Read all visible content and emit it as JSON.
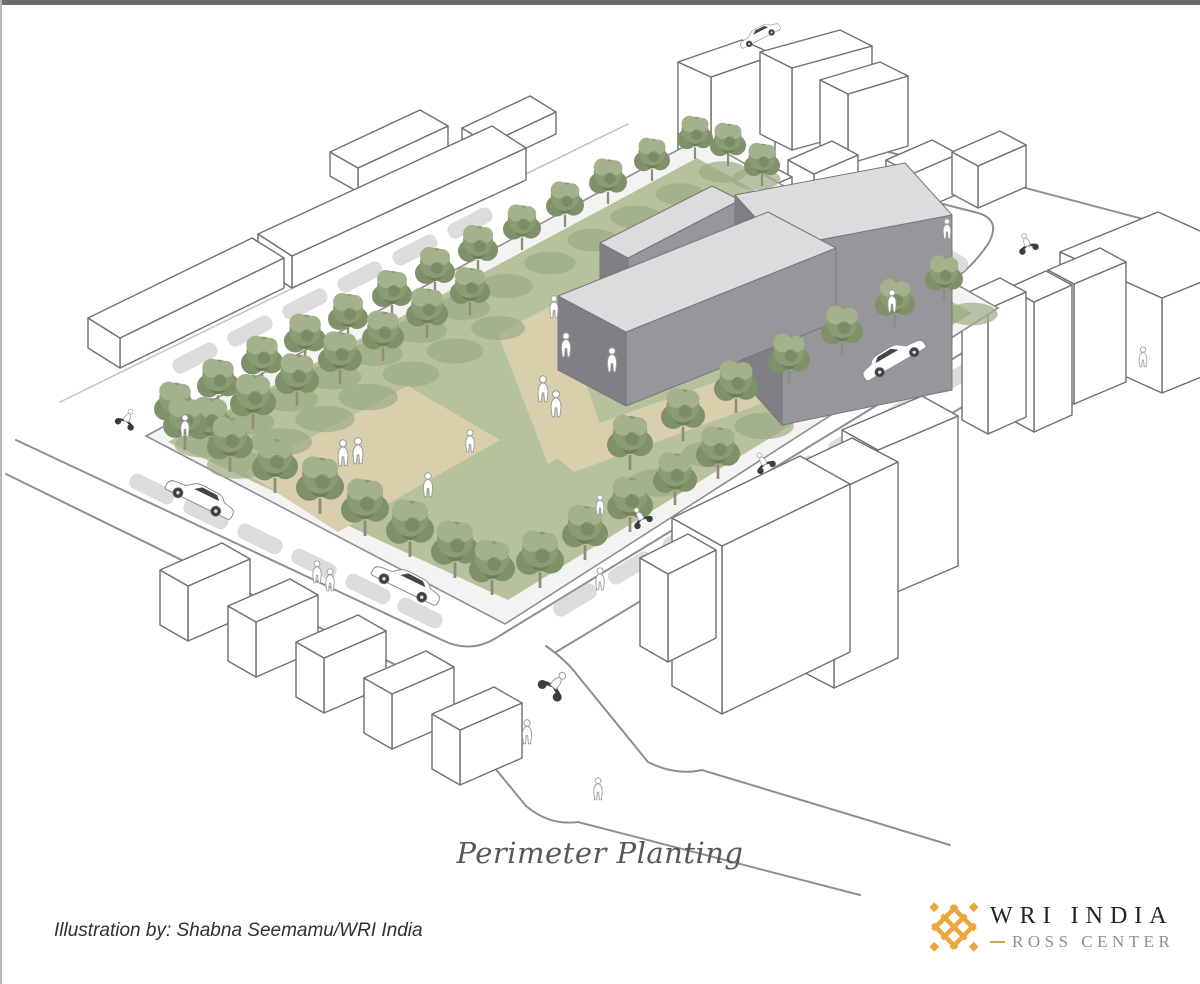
{
  "caption": {
    "title": "Perimeter Planting"
  },
  "attribution": {
    "text": "Illustration by: Shabna Seemamu/WRI India"
  },
  "logo": {
    "org": "WRI INDIA",
    "sub": "ROSS CENTER"
  },
  "colors": {
    "background": "#ffffff",
    "top_bar": "#6a6a6a",
    "border_left": "#b7b7b7",
    "title_color": "#585858",
    "attr_color": "#303030",
    "logo_navy": "#21242e",
    "logo_gray": "#8e8e8e",
    "logo_gold": "#cfa156",
    "brand_gold": "#eaa73c",
    "grass": "#b5c29c",
    "grass_shadow": "#9cab84",
    "path_tan": "#d9cfad",
    "sidewalk": "#f3f3f1",
    "curb": "#8f8f8f",
    "street": "#8f8f8f",
    "street_faint": "#c2c2c2",
    "car_shadow": "#d6d6d6",
    "bldg_fill": "#ffffff",
    "outline": "#707070",
    "roof": "#dcdcde",
    "wall_mid": "#97979b",
    "wall_dark": "#7f7f84",
    "tree_g1": "#8a9c74",
    "tree_g2": "#7f9168",
    "tree_g3": "#a3b28c",
    "tree_g4": "#6e8059",
    "trunk": "#8f8c7c"
  },
  "illustration": {
    "site": {
      "sidewalk": "146,436 700,138 998,308 505,624",
      "grass": "168,442 697,158 972,313 508,600",
      "paths": [
        "245,472 408,386 500,440 338,532",
        "498,334 558,302 602,430 548,464",
        "540,444 760,366 794,392 574,472"
      ]
    },
    "gray_buildings": [
      {
        "roof": "600,243 712,186 740,200 628,258",
        "front": "628,258 740,200 740,242 628,300",
        "end": "600,243 628,258 628,300 600,285"
      },
      {
        "roof": "735,195 905,163 952,215 782,247",
        "front": "782,247 952,215 952,390 782,425",
        "end": "735,195 782,247 782,425 735,372"
      },
      {
        "roof": "558,296 768,212 836,248 626,332",
        "front": "626,332 836,248 836,322 626,406",
        "end": "558,296 626,332 626,406 558,370"
      }
    ],
    "streets": [
      "M 16,440 L 442,640 Q 470,654 496,638 L 1000,330",
      "M 6,474 L 398,666 Q 420,676 434,694 L 526,806",
      "M 546,646 Q 566,660 578,676 L 648,762",
      "M 648,762 Q 676,776 702,770 L 950,845",
      "M 526,806 Q 550,826 578,822 L 860,895",
      "M 556,652 L 1090,330",
      "M 866,146 L 1200,234",
      "M 850,180 L 978,213 Q 1002,220 988,244 Q 972,268 948,284 L 902,318"
    ],
    "streets_faint": [
      "M 60,402 L 628,124"
    ],
    "context_prisms": [
      {
        "q": [
          [
            330,
            152
          ],
          [
            420,
            110
          ],
          [
            448,
            126
          ],
          [
            358,
            168
          ]
        ],
        "h": 24
      },
      {
        "q": [
          [
            462,
            128
          ],
          [
            530,
            96
          ],
          [
            556,
            112
          ],
          [
            488,
            144
          ]
        ],
        "h": 22
      },
      {
        "q": [
          [
            258,
            234
          ],
          [
            492,
            126
          ],
          [
            526,
            148
          ],
          [
            292,
            256
          ]
        ],
        "h": 32
      },
      {
        "q": [
          [
            88,
            318
          ],
          [
            252,
            238
          ],
          [
            284,
            258
          ],
          [
            120,
            338
          ]
        ],
        "h": 30
      },
      {
        "q": [
          [
            678,
            62
          ],
          [
            742,
            40
          ],
          [
            775,
            55
          ],
          [
            711,
            77
          ]
        ],
        "h": 108
      },
      {
        "q": [
          [
            760,
            52
          ],
          [
            840,
            30
          ],
          [
            872,
            46
          ],
          [
            792,
            68
          ]
        ],
        "h": 82
      },
      {
        "q": [
          [
            820,
            80
          ],
          [
            880,
            62
          ],
          [
            908,
            76
          ],
          [
            848,
            94
          ]
        ],
        "h": 70
      },
      {
        "q": [
          [
            788,
            160
          ],
          [
            832,
            141
          ],
          [
            858,
            155
          ],
          [
            814,
            174
          ]
        ],
        "h": 36
      },
      {
        "q": [
          [
            722,
            182
          ],
          [
            766,
            163
          ],
          [
            792,
            177
          ],
          [
            748,
            196
          ]
        ],
        "h": 36
      },
      {
        "q": [
          [
            886,
            160
          ],
          [
            932,
            140
          ],
          [
            958,
            154
          ],
          [
            912,
            174
          ]
        ],
        "h": 40
      },
      {
        "q": [
          [
            952,
            152
          ],
          [
            1000,
            131
          ],
          [
            1026,
            145
          ],
          [
            978,
            166
          ]
        ],
        "h": 42
      },
      {
        "q": [
          [
            1060,
            252
          ],
          [
            1158,
            212
          ],
          [
            1260,
            258
          ],
          [
            1162,
            298
          ]
        ],
        "h": 95
      },
      {
        "q": [
          [
            1048,
            270
          ],
          [
            1100,
            248
          ],
          [
            1126,
            262
          ],
          [
            1074,
            284
          ]
        ],
        "h": 120
      },
      {
        "q": [
          [
            1008,
            288
          ],
          [
            1046,
            271
          ],
          [
            1072,
            285
          ],
          [
            1034,
            302
          ]
        ],
        "h": 130
      },
      {
        "q": [
          [
            962,
            295
          ],
          [
            1000,
            278
          ],
          [
            1026,
            292
          ],
          [
            988,
            309
          ]
        ],
        "h": 125
      },
      {
        "q": [
          [
            842,
            430
          ],
          [
            922,
            396
          ],
          [
            958,
            416
          ],
          [
            878,
            450
          ]
        ],
        "h": 150
      },
      {
        "q": [
          [
            788,
            468
          ],
          [
            852,
            438
          ],
          [
            898,
            462
          ],
          [
            834,
            492
          ]
        ],
        "h": 196
      },
      {
        "q": [
          [
            672,
            518
          ],
          [
            800,
            456
          ],
          [
            850,
            484
          ],
          [
            722,
            546
          ]
        ],
        "h": 168
      },
      {
        "q": [
          [
            640,
            558
          ],
          [
            688,
            534
          ],
          [
            716,
            550
          ],
          [
            668,
            574
          ]
        ],
        "h": 88
      },
      {
        "q": [
          [
            160,
            570
          ],
          [
            222,
            543
          ],
          [
            250,
            559
          ],
          [
            188,
            586
          ]
        ],
        "h": 55
      },
      {
        "q": [
          [
            228,
            606
          ],
          [
            290,
            579
          ],
          [
            318,
            595
          ],
          [
            256,
            622
          ]
        ],
        "h": 55
      },
      {
        "q": [
          [
            296,
            642
          ],
          [
            358,
            615
          ],
          [
            386,
            631
          ],
          [
            324,
            658
          ]
        ],
        "h": 55
      },
      {
        "q": [
          [
            364,
            678
          ],
          [
            426,
            651
          ],
          [
            454,
            667
          ],
          [
            392,
            694
          ]
        ],
        "h": 55
      },
      {
        "q": [
          [
            432,
            714
          ],
          [
            494,
            687
          ],
          [
            522,
            703
          ],
          [
            460,
            730
          ]
        ],
        "h": 55
      }
    ],
    "trees": {
      "back": [
        [
          175,
          432,
          1.05
        ],
        [
          218,
          409,
          1.05
        ],
        [
          262,
          386,
          1.05
        ],
        [
          305,
          364,
          1.05
        ],
        [
          348,
          341,
          1.0
        ],
        [
          392,
          318,
          1.0
        ],
        [
          435,
          295,
          1.0
        ],
        [
          478,
          273,
          1.0
        ],
        [
          522,
          250,
          0.95
        ],
        [
          565,
          227,
          0.95
        ],
        [
          608,
          204,
          0.95
        ],
        [
          652,
          181,
          0.9
        ],
        [
          695,
          159,
          0.9
        ],
        [
          728,
          166,
          0.9
        ],
        [
          762,
          186,
          0.9
        ]
      ],
      "inner_nw": [
        [
          210,
          452,
          1.15
        ],
        [
          253,
          429,
          1.15
        ],
        [
          297,
          406,
          1.1
        ],
        [
          340,
          384,
          1.1
        ],
        [
          383,
          361,
          1.05
        ],
        [
          427,
          338,
          1.05
        ],
        [
          470,
          315,
          1.0
        ]
      ],
      "se_inner": [
        [
          630,
          470,
          1.15
        ],
        [
          683,
          441,
          1.1
        ],
        [
          736,
          413,
          1.1
        ],
        [
          789,
          384,
          1.05
        ],
        [
          842,
          356,
          1.05
        ],
        [
          895,
          327,
          1.0
        ],
        [
          944,
          301,
          0.95
        ]
      ],
      "se_edge": [
        [
          540,
          588,
          1.2
        ],
        [
          585,
          560,
          1.15
        ],
        [
          630,
          532,
          1.15
        ],
        [
          675,
          505,
          1.1
        ],
        [
          718,
          479,
          1.1
        ]
      ],
      "sw_edge": [
        [
          185,
          450,
          1.1
        ],
        [
          230,
          472,
          1.15
        ],
        [
          275,
          493,
          1.15
        ],
        [
          320,
          514,
          1.2
        ],
        [
          365,
          536,
          1.2
        ],
        [
          410,
          557,
          1.2
        ],
        [
          455,
          578,
          1.2
        ],
        [
          492,
          595,
          1.15
        ]
      ]
    },
    "people": [
      [
        554,
        318,
        1.1
      ],
      [
        566,
        357,
        1.2
      ],
      [
        612,
        372,
        1.2
      ],
      [
        543,
        402,
        1.3
      ],
      [
        556,
        417,
        1.3
      ],
      [
        343,
        466,
        1.3
      ],
      [
        358,
        464,
        1.3
      ],
      [
        428,
        497,
        1.2
      ],
      [
        470,
        452,
        1.1
      ],
      [
        892,
        312,
        1.1
      ],
      [
        947,
        239,
        1.0
      ],
      [
        185,
        437,
        1.1
      ],
      [
        317,
        583,
        1.1
      ],
      [
        330,
        591,
        1.1
      ],
      [
        527,
        744,
        1.2
      ],
      [
        600,
        515,
        1.0
      ],
      [
        600,
        590,
        1.1
      ],
      [
        1143,
        367,
        1.0
      ],
      [
        598,
        800,
        1.1
      ]
    ],
    "cars": [
      {
        "x": 196,
        "y": 506,
        "rot": 26,
        "flip": false,
        "s": 1
      },
      {
        "x": 402,
        "y": 592,
        "rot": 26,
        "flip": false,
        "s": 1
      },
      {
        "x": 898,
        "y": 366,
        "rot": -30,
        "flip": true,
        "s": 0.95
      },
      {
        "x": 762,
        "y": 40,
        "rot": -27,
        "flip": false,
        "s": 0.6
      }
    ],
    "scooters": [
      {
        "x": 123,
        "y": 427,
        "rot": 26,
        "s": 1
      },
      {
        "x": 768,
        "y": 470,
        "rot": -30,
        "s": 1
      },
      {
        "x": 645,
        "y": 525,
        "rot": -30,
        "s": 1
      },
      {
        "x": 547,
        "y": 694,
        "rot": 40,
        "s": 1.4
      },
      {
        "x": 1030,
        "y": 252,
        "rot": -20,
        "s": 1
      }
    ],
    "car_shadows": [
      [
        195,
        358,
        -27
      ],
      [
        250,
        331,
        -27
      ],
      [
        305,
        304,
        -27
      ],
      [
        360,
        277,
        -27
      ],
      [
        415,
        250,
        -27
      ],
      [
        470,
        223,
        -27
      ],
      [
        152,
        489,
        26
      ],
      [
        206,
        514,
        26
      ],
      [
        260,
        539,
        26
      ],
      [
        314,
        564,
        26
      ],
      [
        368,
        589,
        26
      ],
      [
        420,
        613,
        26
      ],
      [
        575,
        600,
        -31
      ],
      [
        630,
        568,
        -31
      ],
      [
        685,
        536,
        -31
      ],
      [
        740,
        504,
        -31
      ],
      [
        795,
        472,
        -31
      ],
      [
        850,
        440,
        -31
      ],
      [
        905,
        408,
        -31
      ],
      [
        958,
        376,
        -31
      ],
      [
        862,
        204,
        30
      ],
      [
        904,
        230,
        30
      ],
      [
        946,
        256,
        30
      ]
    ]
  }
}
